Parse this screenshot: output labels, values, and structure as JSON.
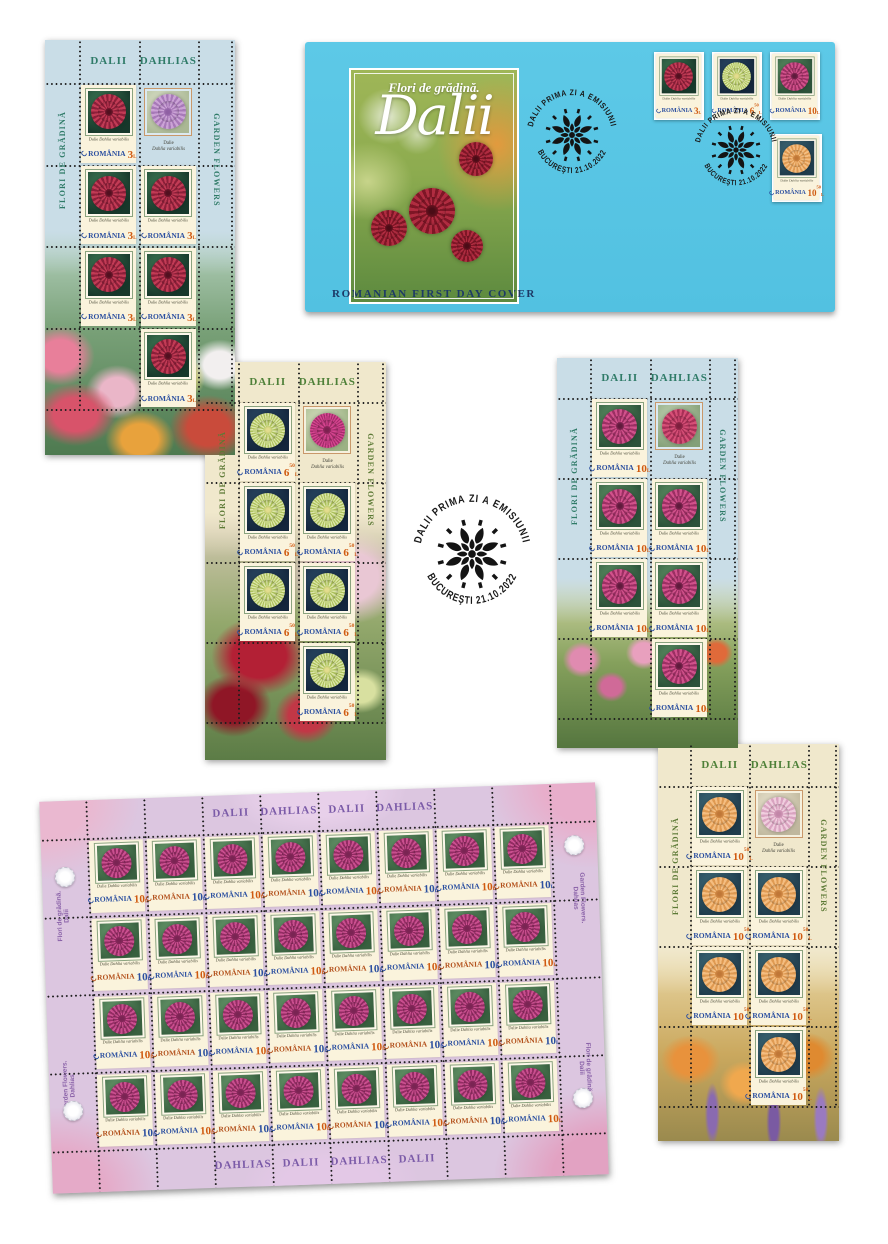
{
  "palette": {
    "envelope_blue": "#57c6e4",
    "sheet_blue": "#c9dde7",
    "sheet_cream": "#f0e8cc",
    "large_sheet_lilac": "#dcc6e0",
    "value_orange": "#d05a10",
    "country_blue": "#2b4fa0",
    "postmark_black": "#181818"
  },
  "common": {
    "header_ro": "DALII",
    "header_en": "DAHLIAS",
    "side_ro": "FLORI DE GRĂDINĂ",
    "side_en": "GARDEN FLOWERS",
    "species_ro": "Dalie",
    "species_la": "Dahlia variabilis",
    "country": "ROMÂNIA",
    "currency": "L"
  },
  "stamps": {
    "red": {
      "value_int": "3",
      "value_sup": ""
    },
    "green": {
      "value_int": "6",
      "value_sup": "50"
    },
    "pink": {
      "value_int": "10",
      "value_sup": ""
    },
    "orange": {
      "value_int": "10",
      "value_sup": "50"
    },
    "large": {
      "value_int": "10",
      "value_sup": ""
    }
  },
  "fdc": {
    "title_line": "Flori de grădină.",
    "title_main": "Dalii",
    "caption": "ROMANIAN FIRST DAY COVER"
  },
  "postmark": {
    "arc_top": "DALII  PRIMA ZI A EMISIUNII",
    "arc_bottom": "BUCUREŞTI 21.10.2022"
  },
  "large_sheet": {
    "stamp_count": 32,
    "top_labels": [
      "DALII",
      "DAHLIAS",
      "DALII",
      "DAHLIAS"
    ],
    "bottom_labels": [
      "DAHLIAS",
      "DALII",
      "DAHLIAS",
      "DALII"
    ],
    "side_left_upper": {
      "l1": "Flori de grădină.",
      "l2": "Dalii"
    },
    "side_left_lower": {
      "l1": "Garden Flowers.",
      "l2": "Dahlias"
    },
    "side_right_upper": {
      "l1": "Garden Flowers.",
      "l2": "Dahlias"
    },
    "side_right_lower": {
      "l1": "Flori de grădină.",
      "l2": "Dalii"
    }
  }
}
